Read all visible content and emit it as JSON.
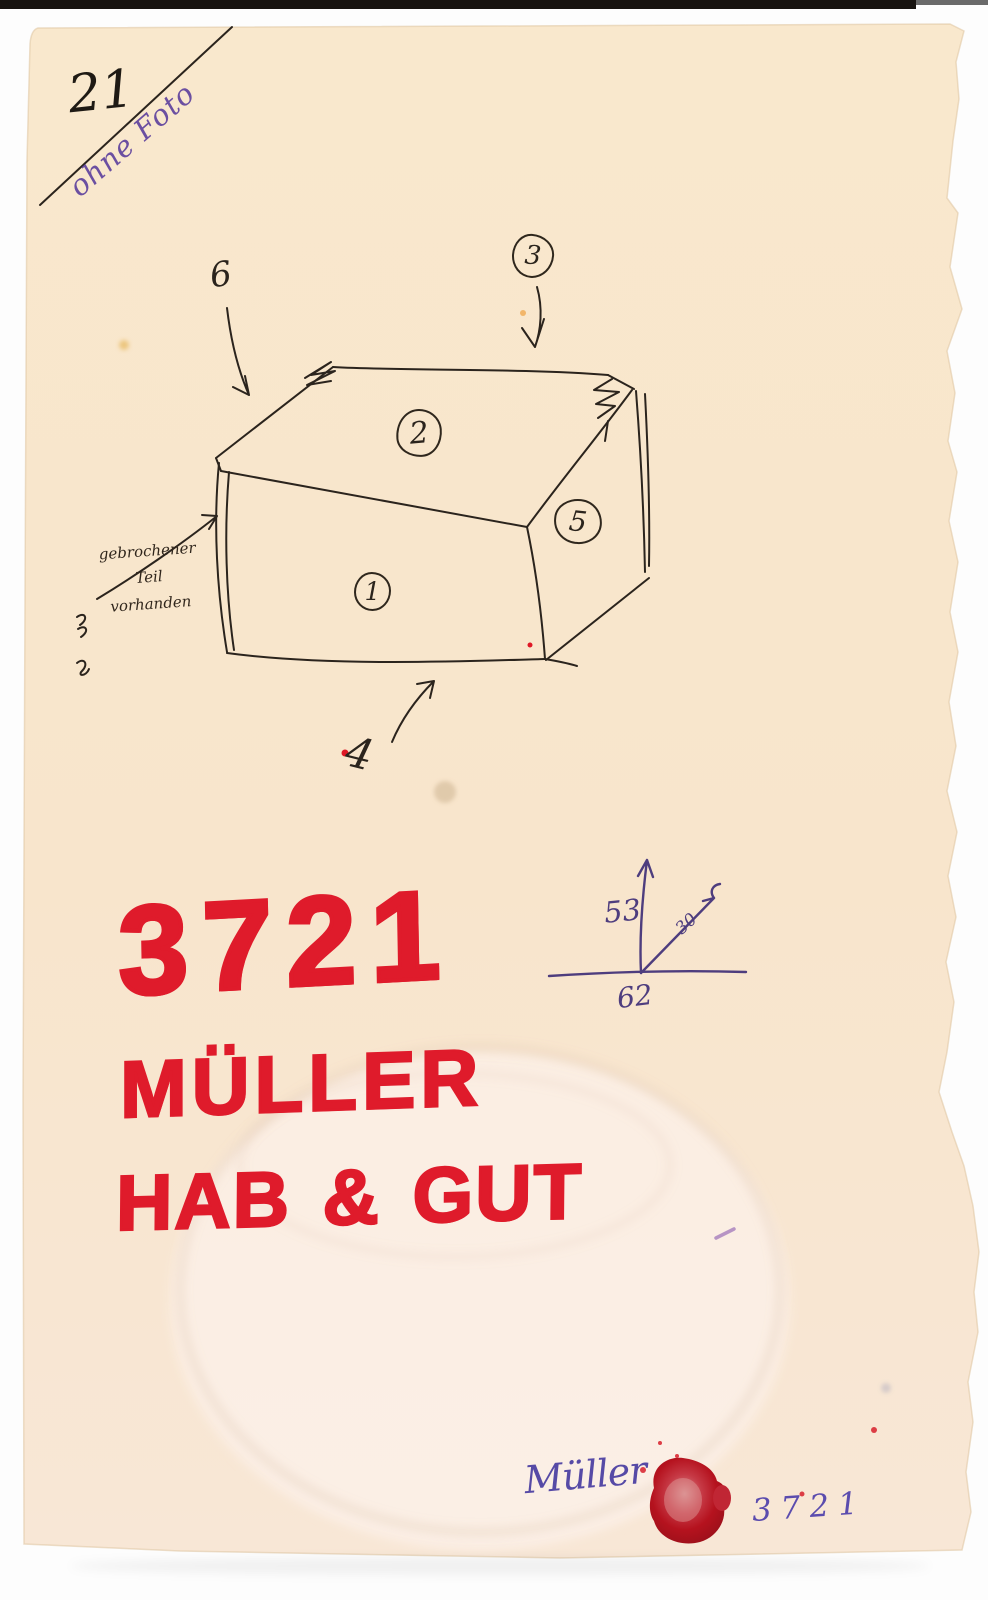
{
  "header": {
    "card_number": "21",
    "photo_note": "ohne Foto"
  },
  "sketch": {
    "labels": {
      "top_face": "2",
      "front_face": "1",
      "side_face": "5",
      "top_arrow": "3",
      "left_arrow": "6",
      "bottom_arrow": "4"
    },
    "note": {
      "line1": "gebrochener",
      "line2": "Teil",
      "line3": "vorhanden"
    }
  },
  "dimensions": {
    "vertical": "53",
    "diagonal": "30",
    "horizontal": "62"
  },
  "red_lettering": {
    "inventory_number": "3721",
    "owner": "MÜLLER",
    "estate": "HAB & GUT"
  },
  "footer": {
    "signature": "Müller",
    "inventory_number": "3721"
  },
  "colors": {
    "paper": "#f8e7cd",
    "red_marker": "#df1b2b",
    "violet_ink": "#4e3d7e",
    "blue_ink": "#564aa6",
    "black_ink": "#2b241d",
    "wax_seal": "#b5121e"
  }
}
